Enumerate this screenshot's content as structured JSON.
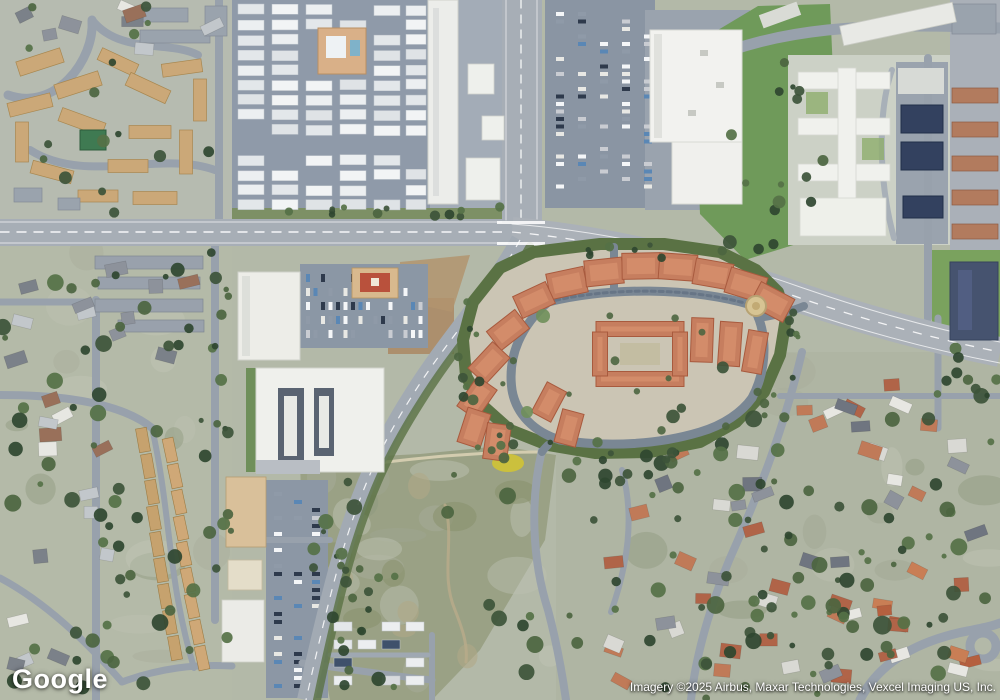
{
  "watermark": {
    "logo_text": "Google"
  },
  "attribution": {
    "text": "Imagery ©2025 Airbus, Maxar Technologies, Vexcel Imaging US, Inc."
  },
  "map": {
    "imagery_type": "satellite",
    "colors": {
      "asphalt_major": "#a7aeb6",
      "asphalt_minor": "#98a1ac",
      "park_street": "#8f9aa9",
      "grass": "#6f9a5a",
      "scrub": "#9aa185",
      "suburb_base": "#b3b9a8",
      "white_roof": "#eef0ec",
      "tan_roof": "#cba878",
      "red_roof": "#c67e5f",
      "red_roof_dark": "#a85a3e",
      "tree_dark": "#3d5439",
      "tree_mid": "#557147",
      "dev_ground": "#cbc5b4",
      "greenbelt": "#5a7244",
      "navy_roof": "#46536f",
      "solar_panel": "#33415f",
      "dirt": "#ab8b66",
      "wildflower_yellow": "#d4c530"
    }
  }
}
